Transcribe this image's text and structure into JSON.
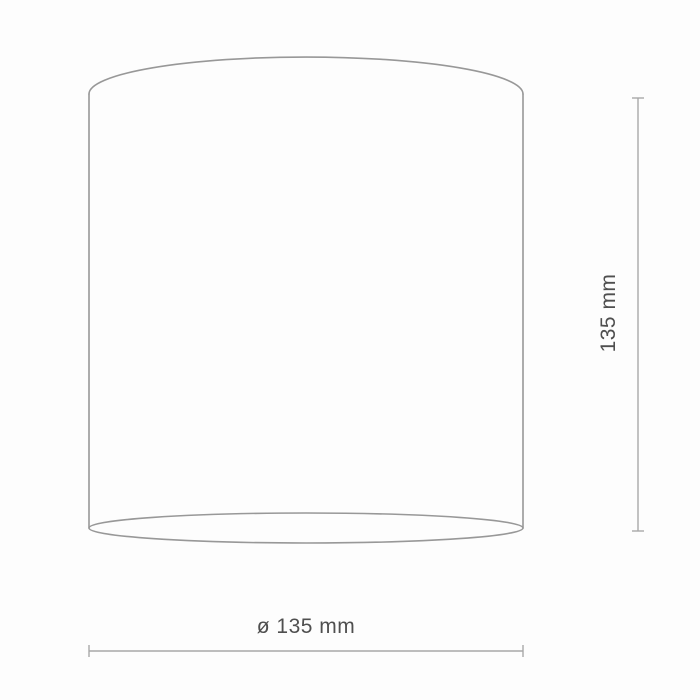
{
  "drawing": {
    "title": "cylinder-dimension-drawing",
    "height_dimension": {
      "label": "135 mm",
      "orientation": "vertical"
    },
    "diameter_dimension": {
      "label": "ø 135 mm",
      "orientation": "horizontal"
    },
    "colors": {
      "background": "#fdfdfd",
      "outline": "#989898",
      "dimension_line": "#a8a8a8",
      "text": "#4f4f4f"
    }
  }
}
